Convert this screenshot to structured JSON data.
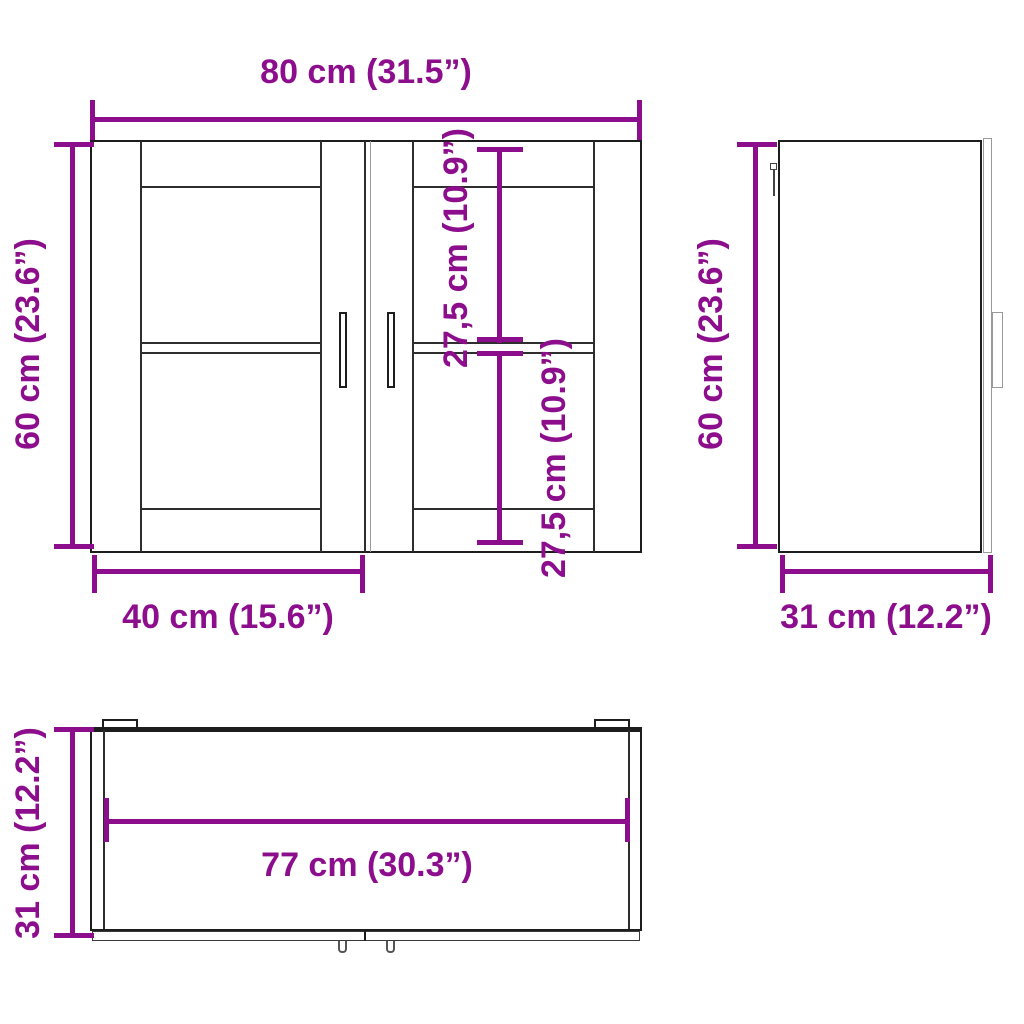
{
  "diagram": {
    "title": "Wall cabinet dimension diagram",
    "colors": {
      "dimension": "#8d0e8d",
      "line_dark": "#1d1d1d",
      "line_mid": "#2e2e2e",
      "line_light": "#9a9a9a"
    },
    "front_view": {
      "width_label": "80 cm (31.5”)",
      "height_label": "60 cm (23.6”)",
      "upper_section_label": "27,5 cm (10.9”)",
      "lower_section_label": "27,5 cm (10.9”)",
      "door_width_label": "40 cm (15.6”)"
    },
    "side_view": {
      "height_label": "60 cm (23.6”)",
      "depth_label": "31 cm (12.2”)"
    },
    "top_view": {
      "depth_label": "31 cm (12.2”)",
      "inner_width_label": "77 cm (30.3”)"
    }
  }
}
